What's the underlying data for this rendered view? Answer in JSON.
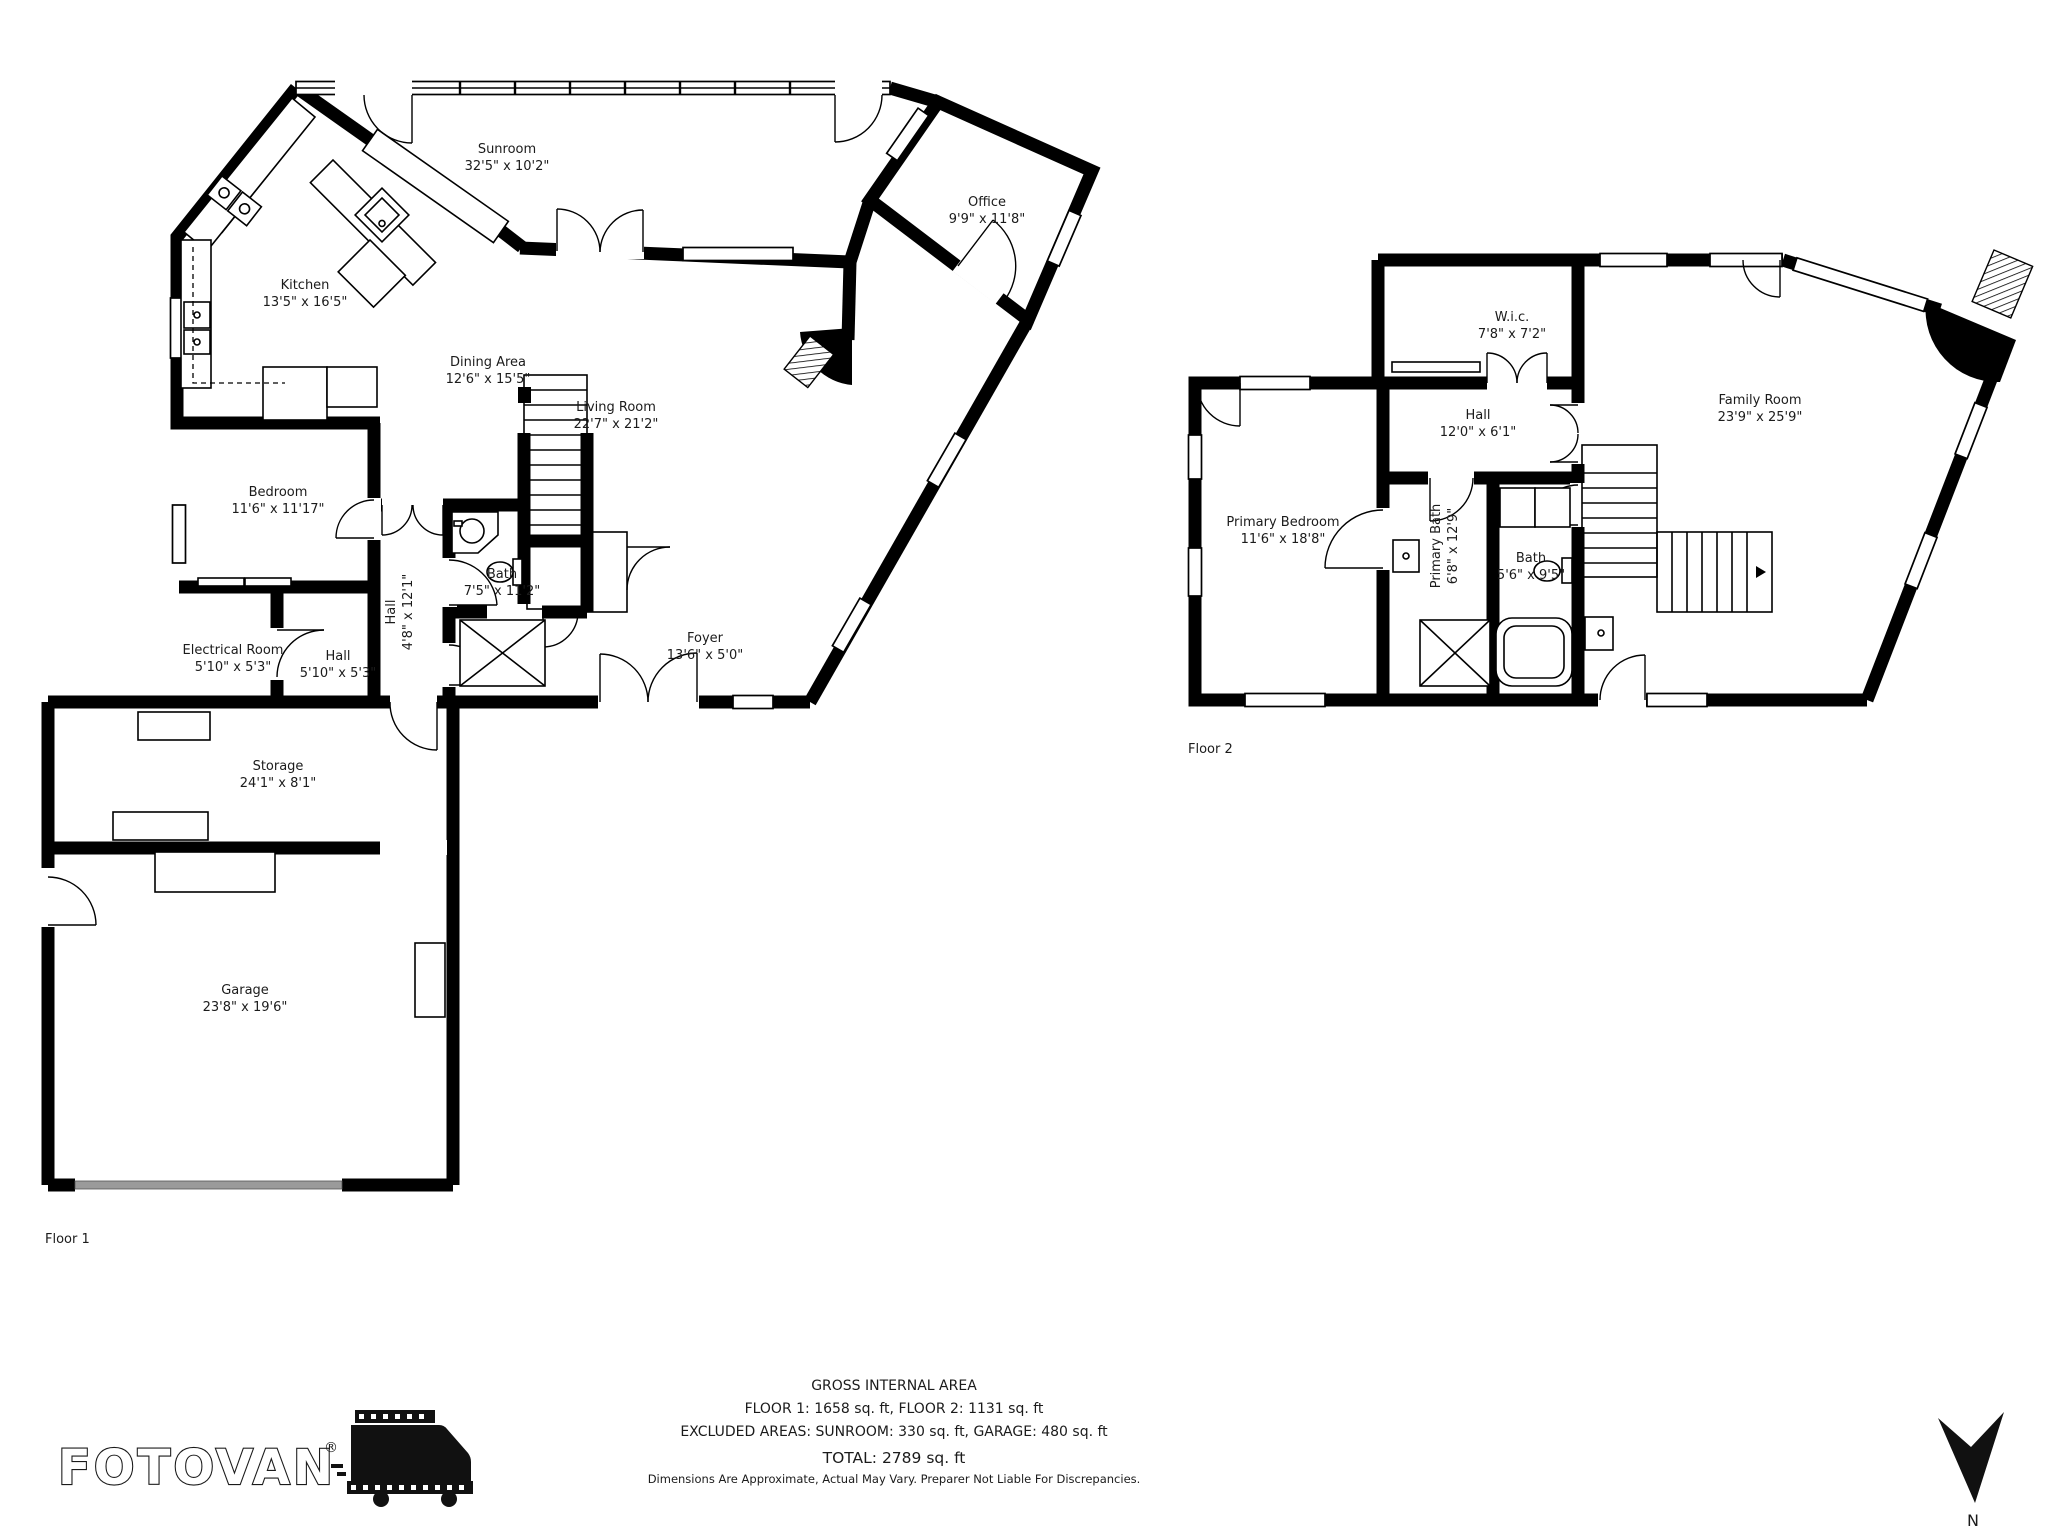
{
  "floor1": {
    "label": "Floor 1",
    "rooms": {
      "sunroom": {
        "name": "Sunroom",
        "dims": "32'5\" x 10'2\""
      },
      "office": {
        "name": "Office",
        "dims": "9'9\" x 11'8\""
      },
      "kitchen": {
        "name": "Kitchen",
        "dims": "13'5\" x 16'5\""
      },
      "dining": {
        "name": "Dining Area",
        "dims": "12'6\" x 15'5\""
      },
      "living": {
        "name": "Living Room",
        "dims": "22'7\" x 21'2\""
      },
      "bedroom": {
        "name": "Bedroom",
        "dims": "11'6\" x 11'17\""
      },
      "bath": {
        "name": "Bath",
        "dims": "7'5\" x 11'2\""
      },
      "hall_main": {
        "name": "Hall",
        "dims": "4'8\" x 12'1\""
      },
      "electrical": {
        "name": "Electrical Room",
        "dims": "5'10\" x 5'3\""
      },
      "hall_small": {
        "name": "Hall",
        "dims": "5'10\" x 5'3\""
      },
      "foyer": {
        "name": "Foyer",
        "dims": "13'6\" x 5'0\""
      },
      "storage": {
        "name": "Storage",
        "dims": "24'1\" x 8'1\""
      },
      "garage": {
        "name": "Garage",
        "dims": "23'8\" x 19'6\""
      }
    }
  },
  "floor2": {
    "label": "Floor 2",
    "rooms": {
      "wic": {
        "name": "W.i.c.",
        "dims": "7'8\" x 7'2\""
      },
      "hall": {
        "name": "Hall",
        "dims": "12'0\" x 6'1\""
      },
      "family": {
        "name": "Family Room",
        "dims": "23'9\" x 25'9\""
      },
      "primary_bedroom": {
        "name": "Primary Bedroom",
        "dims": "11'6\" x 18'8\""
      },
      "primary_bath": {
        "name": "Primary Bath",
        "dims": "6'8\" x 12'9\""
      },
      "bath": {
        "name": "Bath",
        "dims": "5'6\" x 9'5\""
      }
    }
  },
  "footer": {
    "title": "GROSS INTERNAL AREA",
    "floors_line": "FLOOR 1: 1658 sq. ft, FLOOR 2: 1131 sq. ft",
    "excluded_line": "EXCLUDED AREAS: SUNROOM: 330 sq. ft, GARAGE: 480 sq. ft",
    "total_line": "TOTAL: 2789 sq. ft",
    "disclaimer": "Dimensions Are Approximate, Actual May Vary. Preparer Not Liable For Discrepancies."
  },
  "branding": {
    "logo_text": "FOTOVAN",
    "registered_mark": "®"
  },
  "compass": {
    "north_label": "N"
  }
}
